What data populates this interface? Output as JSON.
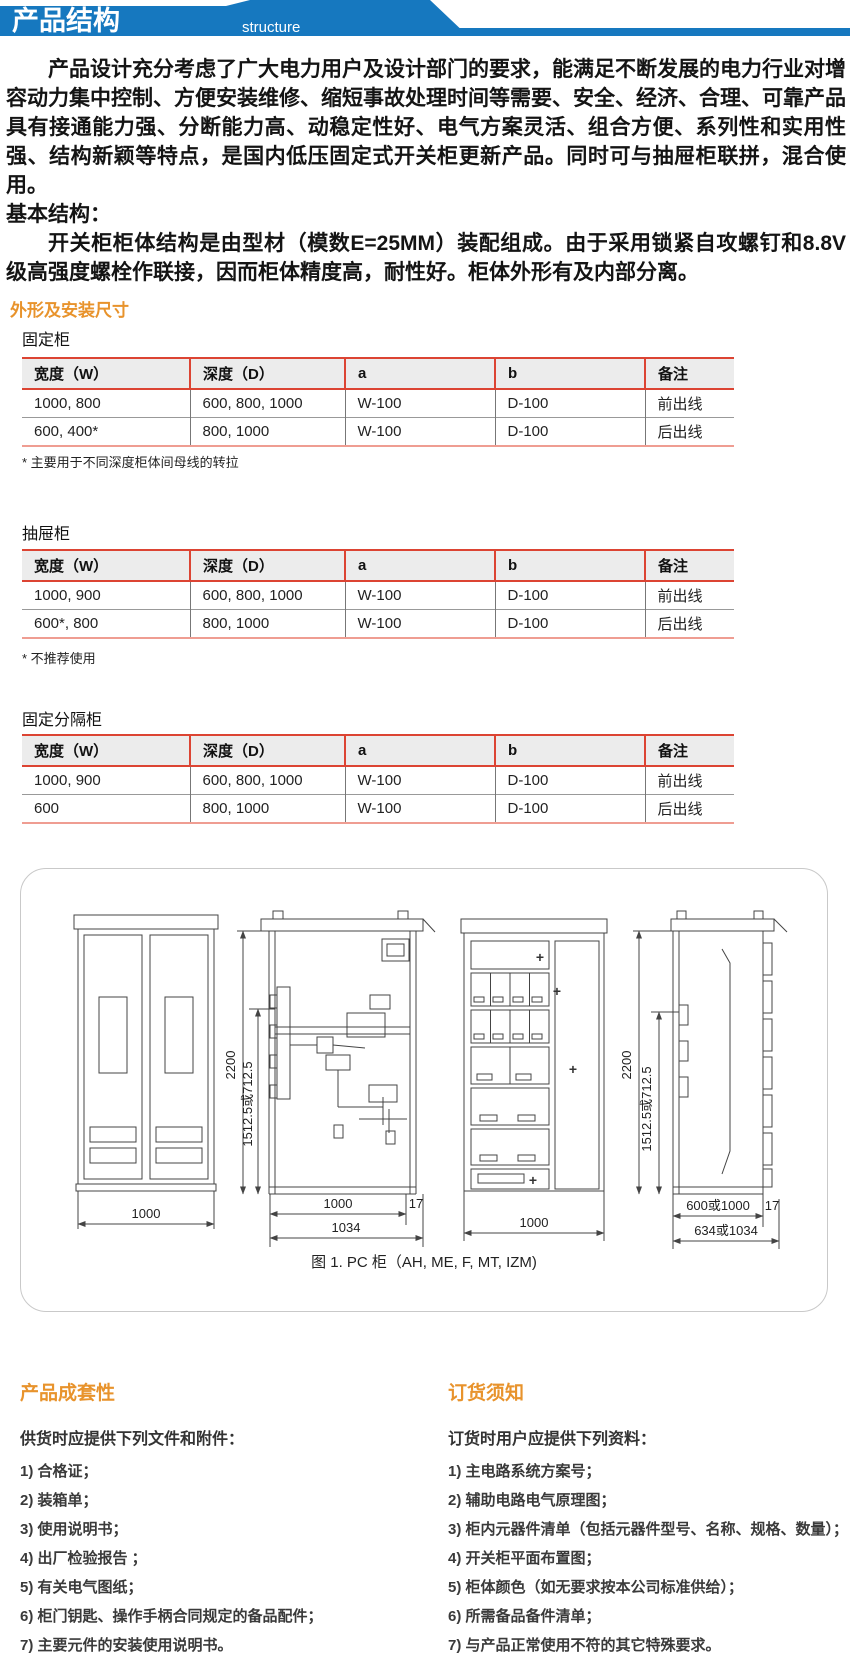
{
  "header": {
    "title": "产品结构",
    "subtitle": "structure",
    "banner_color": "#1678bf"
  },
  "intro": {
    "paragraph1": "产品设计充分考虑了广大电力用户及设计部门的要求，能满足不断发展的电力行业对增容动力集中控制、方便安装维修、缩短事故处理时间等需要、安全、经济、合理、可靠产品具有接通能力强、分断能力高、动稳定性好、电气方案灵活、组合方便、系列性和实用性强、结构新颖等特点，是国内低压固定式开关柜更新产品。同时可与抽屉柜联拼，混合使用。",
    "basic_structure_label": "基本结构：",
    "paragraph2": "开关柜柜体结构是由型材（模数E=25MM）装配组成。由于采用锁紧自攻螺钉和8.8V级高强度螺栓作联接，因而柜体精度高，耐性好。柜体外形有及内部分离。"
  },
  "dimensions_section": {
    "heading": "外形及安装尺寸",
    "tables": [
      {
        "title": "固定柜",
        "headers": [
          "宽度（W）",
          "深度（D）",
          "a",
          "b",
          "备注"
        ],
        "rows": [
          [
            "1000, 800",
            "600, 800, 1000",
            "W-100",
            "D-100",
            "前出线"
          ],
          [
            "600, 400*",
            "800, 1000",
            "W-100",
            "D-100",
            "后出线"
          ]
        ],
        "footnote": "* 主要用于不同深度柜体间母线的转拉"
      },
      {
        "title": "抽屉柜",
        "headers": [
          "宽度（W）",
          "深度（D）",
          "a",
          "b",
          "备注"
        ],
        "rows": [
          [
            "1000, 900",
            "600, 800, 1000",
            "W-100",
            "D-100",
            "前出线"
          ],
          [
            "600*, 800",
            "800, 1000",
            "W-100",
            "D-100",
            "后出线"
          ]
        ],
        "footnote": "* 不推荐使用"
      },
      {
        "title": "固定分隔柜",
        "headers": [
          "宽度（W）",
          "深度（D）",
          "a",
          "b",
          "备注"
        ],
        "rows": [
          [
            "1000, 900",
            "600, 800, 1000",
            "W-100",
            "D-100",
            "前出线"
          ],
          [
            "600",
            "800, 1000",
            "W-100",
            "D-100",
            "后出线"
          ]
        ],
        "footnote": ""
      }
    ]
  },
  "figure": {
    "caption": "图 1. PC 柜（AH, ME, F, MT, IZM)",
    "labels": {
      "cab1_width": "1000",
      "cab2_height": "2200",
      "cab2_mid_height": "1512.5或712.5",
      "cab2_inner_width": "1000",
      "cab2_outer_width": "1034",
      "cab2_offset": "17",
      "cab3_width": "1000",
      "cab4_height": "2200",
      "cab4_mid_height": "1512.5或712.5",
      "cab4_inner_width": "600或1000",
      "cab4_outer_width": "634或1034",
      "cab4_offset": "17"
    }
  },
  "completeness_section": {
    "heading": "产品成套性",
    "intro": "供货时应提供下列文件和附件：",
    "items": [
      "1) 合格证；",
      "2) 装箱单；",
      "3) 使用说明书；",
      "4) 出厂检验报告 ；",
      "5) 有关电气图纸；",
      "6) 柜门钥匙、操作手柄合同规定的备品配件；",
      "7) 主要元件的安装使用说明书。"
    ]
  },
  "ordering_section": {
    "heading": "订货须知",
    "intro": "订货时用户应提供下列资料：",
    "items": [
      "1) 主电路系统方案号；",
      "2) 辅助电路电气原理图；",
      "3) 柜内元器件清单（包括元器件型号、名称、规格、数量）；",
      "4) 开关柜平面布置图；",
      "5) 柜体颜色（如无要求按本公司标准供给）；",
      "6) 所需备品备件清单；",
      "7) 与产品正常使用不符的其它特殊要求。"
    ]
  }
}
